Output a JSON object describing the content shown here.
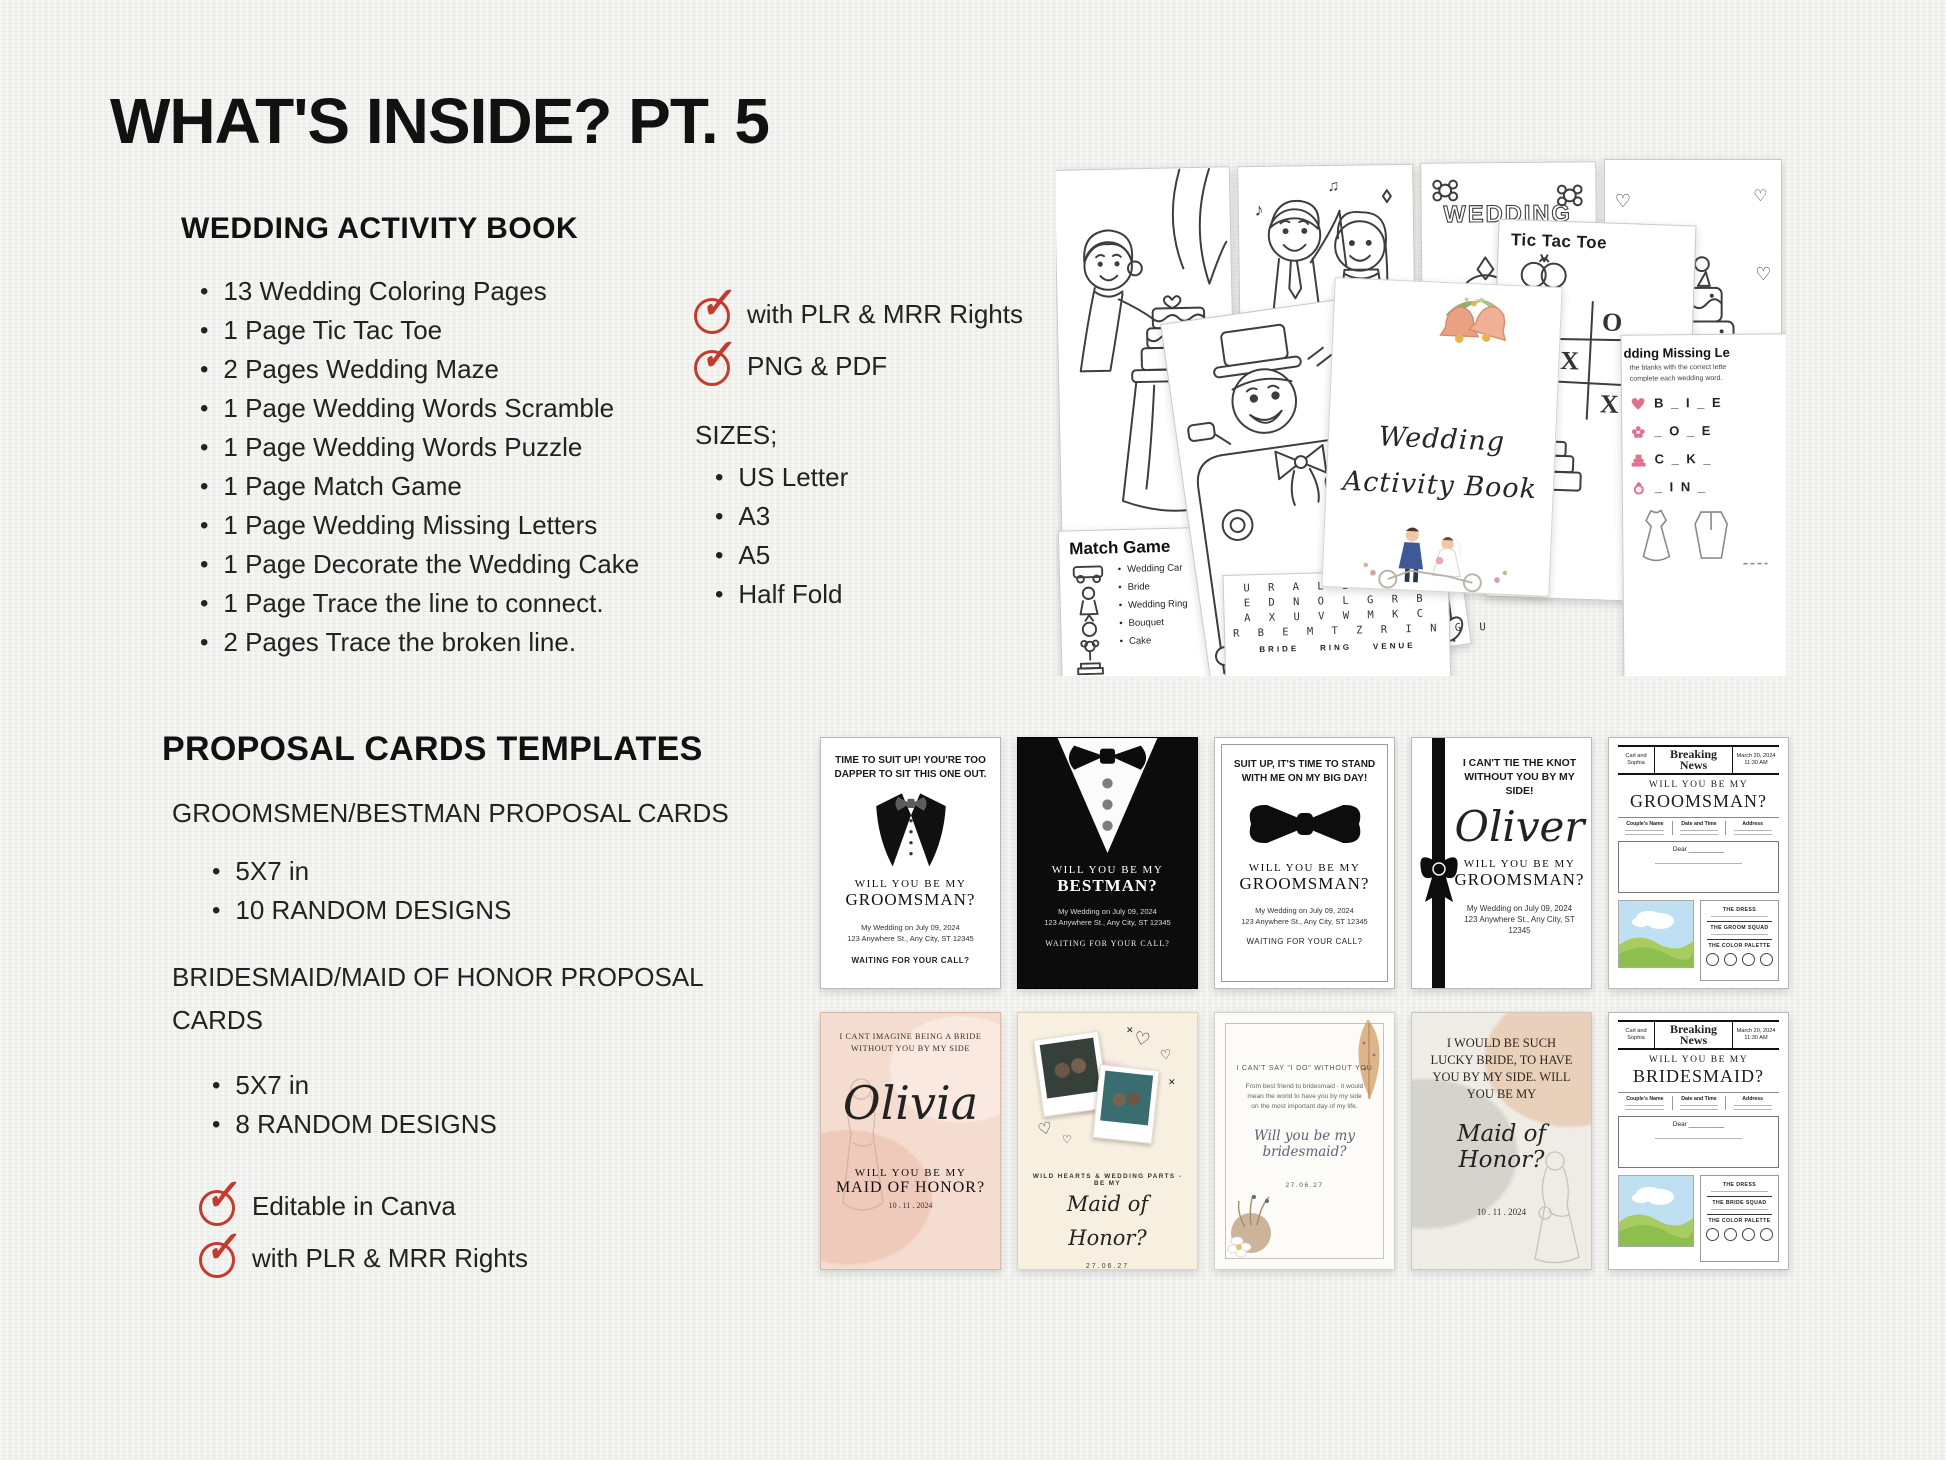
{
  "page": {
    "title": "WHAT'S INSIDE? PT. 5"
  },
  "activity_book": {
    "heading": "WEDDING ACTIVITY BOOK",
    "items": [
      "13 Wedding Coloring Pages",
      "1 Page Tic Tac Toe",
      "2 Pages Wedding Maze",
      "1 Page Wedding Words Scramble",
      "1 Page Wedding Words Puzzle",
      "1 Page Match Game",
      "1 Page Wedding Missing Letters",
      "1 Page Decorate the Wedding Cake",
      "1 Page Trace the line to connect.",
      "2 Pages Trace the broken line."
    ],
    "checks": [
      "with PLR & MRR Rights",
      "PNG & PDF"
    ],
    "sizes_label": "SIZES;",
    "sizes": [
      "US Letter",
      "A3",
      "A5",
      "Half Fold"
    ]
  },
  "proposal": {
    "heading": "PROPOSAL CARDS TEMPLATES",
    "groomsmen_subheading": "GROOMSMEN/BESTMAN PROPOSAL CARDS",
    "groomsmen_items": [
      "5X7 in",
      "10 RANDOM DESIGNS"
    ],
    "bridesmaid_subheading": "BRIDESMAID/MAID OF HONOR PROPOSAL CARDS",
    "bridesmaid_items": [
      "5X7 in",
      "8 RANDOM DESIGNS"
    ],
    "checks": [
      "Editable in Canva",
      "with PLR & MRR Rights"
    ]
  },
  "collage": {
    "cover": {
      "line1": "Wedding",
      "line2": "Activity Book"
    },
    "wedding_word": "WEDDING",
    "sign_line1": "JUST",
    "sign_line2": "MARRIED",
    "match_game": {
      "title": "Match Game",
      "items": [
        "Wedding Car",
        "Bride",
        "Wedding Ring",
        "Bouquet",
        "Cake"
      ]
    },
    "word_search": {
      "rows": [
        "U R A L I R I S",
        "E D N O L G R B",
        "A X U V W M K C",
        "R B E M T Z R I N G U",
        "Z X L W I P N D D X Y H"
      ],
      "answers": "BRIDE    RING    VENUE"
    },
    "tic_tac_toe": {
      "title": "Tic Tac Toe",
      "cells": [
        "X",
        "",
        "O",
        "",
        "X",
        "",
        "O",
        "",
        "X"
      ]
    },
    "missing_letters": {
      "title": "dding Missing Le",
      "line1": "the blanks with the correct lette",
      "line2": "complete each wedding word.",
      "words": [
        "B _ I _ E",
        "_ O _ E",
        "C _ K _",
        "_ I N _"
      ]
    }
  },
  "cards_row1": [
    {
      "message": "TIME TO SUIT UP! YOU'RE TOO DAPPER TO SIT THIS ONE OUT.",
      "will": "WILL YOU BE MY",
      "role": "GROOMSMAN?",
      "date_line": "My Wedding on July 09, 2024",
      "address": "123 Anywhere St., Any City, ST 12345",
      "footer": "WAITING FOR YOUR CALL?"
    },
    {
      "will": "WILL YOU BE MY",
      "role": "BESTMAN?",
      "date_line": "My Wedding on July 09, 2024",
      "address": "123 Anywhere St., Any City, ST 12345",
      "footer": "WAITING FOR YOUR CALL?"
    },
    {
      "message": "SUIT UP, IT'S TIME TO STAND WITH ME ON MY BIG DAY!",
      "will": "WILL YOU BE MY",
      "role": "GROOMSMAN?",
      "date_line": "My Wedding on July 09, 2024",
      "address": "123 Anywhere St., Any City, ST 12345",
      "footer": "WAITING FOR YOUR CALL?"
    },
    {
      "message": "I CAN'T TIE THE KNOT WITHOUT YOU BY MY SIDE!",
      "name": "Oliver",
      "will": "WILL YOU BE MY",
      "role": "GROOMSMAN?",
      "date_line": "My Wedding on July 09, 2024",
      "address": "123 Anywhere St., Any City, ST 12345"
    },
    {
      "names": "Carl and Sophia",
      "paper": "Breaking News",
      "news_date": "March 20, 2024",
      "news_time": "11:30 AM",
      "will": "WILL YOU BE MY",
      "role": "GROOMSMAN?",
      "columns": [
        "Couple's Name",
        "Date and Time",
        "Address"
      ],
      "dear": "Dear __________",
      "sections": [
        "THE DRESS",
        "THE GROOM SQUAD",
        "THE COLOR PALETTE"
      ]
    }
  ],
  "cards_row2": [
    {
      "message": "I CANT IMAGINE BEING A BRIDE WITHOUT YOU BY MY SIDE",
      "name": "Olivia",
      "will": "WILL YOU BE MY",
      "role": "MAID OF HONOR?",
      "date_line": "10 . 11 . 2024"
    },
    {
      "tagline": "WILD HEARTS & WEDDING PARTS - BE MY",
      "role": "Maid of Honor?",
      "date_line": "27.06.27"
    },
    {
      "message": "I CAN'T SAY \"I DO\" WITHOUT YOU",
      "body": "From best friend to bridesmaid - it would mean the world to have you by my side on the most important day of my life.",
      "script_line": "Will you be my bridesmaid?",
      "date_line": "27.06.27"
    },
    {
      "message": "I WOULD BE SUCH LUCKY BRIDE, TO HAVE YOU BY MY SIDE. WILL YOU BE MY",
      "script_line": "Maid of Honor?",
      "date_line": "10 . 11 . 2024"
    },
    {
      "names": "Carl and Sophia",
      "paper": "Breaking News",
      "news_date": "March 20, 2024",
      "news_time": "11:30 AM",
      "will": "WILL YOU BE MY",
      "role": "BRIDESMAID?",
      "columns": [
        "Couple's Name",
        "Date and Time",
        "Address"
      ],
      "dear": "Dear __________",
      "sections": [
        "THE DRESS",
        "THE BRIDE SQUAD",
        "THE COLOR PALETTE"
      ]
    }
  ],
  "colors": {
    "accent_red": "#c23b2e",
    "ink": "#1b1b1b",
    "paper": "#f1f1ee"
  }
}
